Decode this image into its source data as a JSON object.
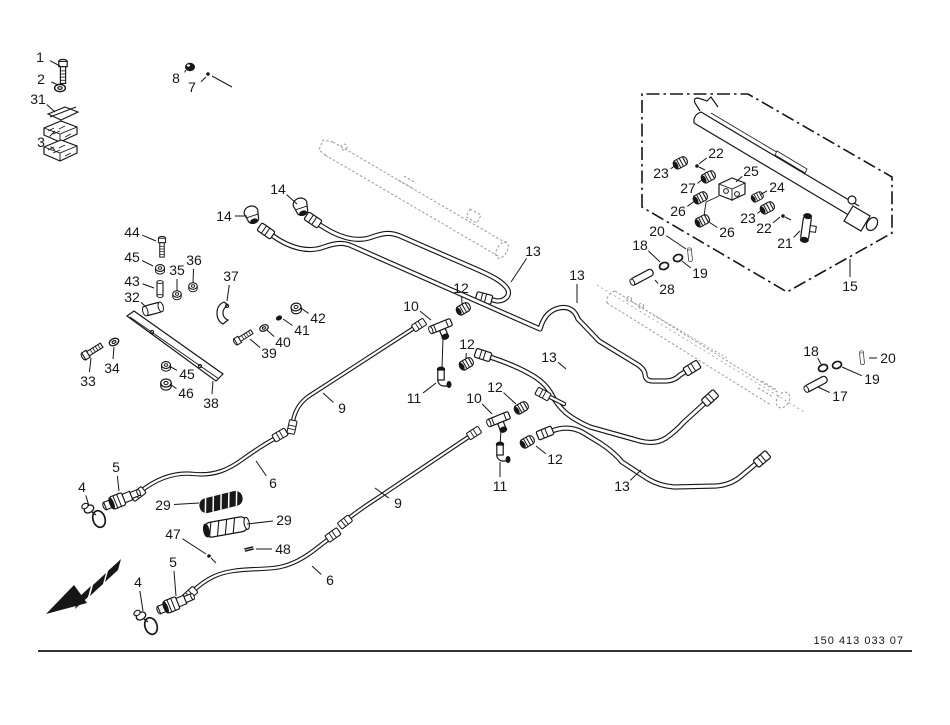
{
  "page": {
    "width": 950,
    "height": 725,
    "background": "#ffffff"
  },
  "colors": {
    "line": "#161616",
    "ghost": "#9a9a9a",
    "fill": "#ffffff"
  },
  "footer": {
    "drawing_number": "150 413 033 07"
  },
  "labels": [
    {
      "text": "1",
      "x": 40,
      "y": 57,
      "tx": 60,
      "ty": 66
    },
    {
      "text": "2",
      "x": 41,
      "y": 79,
      "tx": 58,
      "ty": 85
    },
    {
      "text": "31",
      "x": 38,
      "y": 99,
      "tx": 55,
      "ty": 112
    },
    {
      "text": "3",
      "x": 41,
      "y": 142,
      "tx": 55,
      "ty": 131,
      "tx2": 55,
      "ty2": 150
    },
    {
      "text": "8",
      "x": 176,
      "y": 78,
      "tx": 186,
      "ty": 70
    },
    {
      "text": "7",
      "x": 192,
      "y": 87,
      "tx": 206,
      "ty": 77
    },
    {
      "text": "14",
      "x": 224,
      "y": 216,
      "tx": 247,
      "ty": 216
    },
    {
      "text": "14",
      "x": 278,
      "y": 189,
      "tx": 297,
      "ty": 204
    },
    {
      "text": "44",
      "x": 132,
      "y": 232,
      "tx": 156,
      "ty": 241
    },
    {
      "text": "45",
      "x": 132,
      "y": 257,
      "tx": 153,
      "ty": 266
    },
    {
      "text": "43",
      "x": 132,
      "y": 281,
      "tx": 154,
      "ty": 288
    },
    {
      "text": "32",
      "x": 132,
      "y": 297,
      "tx": 146,
      "ty": 307
    },
    {
      "text": "35",
      "x": 177,
      "y": 270,
      "tx": 177,
      "ty": 291
    },
    {
      "text": "36",
      "x": 194,
      "y": 260,
      "tx": 193,
      "ty": 283
    },
    {
      "text": "37",
      "x": 231,
      "y": 276,
      "tx": 227,
      "ty": 301
    },
    {
      "text": "42",
      "x": 318,
      "y": 318,
      "tx": 301,
      "ty": 308
    },
    {
      "text": "41",
      "x": 302,
      "y": 330,
      "tx": 283,
      "ty": 319
    },
    {
      "text": "40",
      "x": 283,
      "y": 342,
      "tx": 267,
      "ty": 330
    },
    {
      "text": "39",
      "x": 269,
      "y": 353,
      "tx": 250,
      "ty": 339
    },
    {
      "text": "33",
      "x": 88,
      "y": 381,
      "tx": 91,
      "ty": 358
    },
    {
      "text": "34",
      "x": 112,
      "y": 368,
      "tx": 114,
      "ty": 347
    },
    {
      "text": "45",
      "x": 187,
      "y": 374,
      "tx": 169,
      "ty": 366
    },
    {
      "text": "46",
      "x": 186,
      "y": 393,
      "tx": 170,
      "ty": 384
    },
    {
      "text": "38",
      "x": 211,
      "y": 403,
      "tx": 213,
      "ty": 381
    },
    {
      "text": "9",
      "x": 342,
      "y": 408,
      "tx": 323,
      "ty": 393
    },
    {
      "text": "9",
      "x": 398,
      "y": 503,
      "tx": 375,
      "ty": 488
    },
    {
      "text": "13",
      "x": 533,
      "y": 251,
      "tx": 511,
      "ty": 282
    },
    {
      "text": "13",
      "x": 577,
      "y": 275,
      "tx": 577,
      "ty": 303
    },
    {
      "text": "13",
      "x": 549,
      "y": 357,
      "tx": 566,
      "ty": 369
    },
    {
      "text": "13",
      "x": 622,
      "y": 486,
      "tx": 641,
      "ty": 470
    },
    {
      "text": "12",
      "x": 461,
      "y": 288,
      "tx": 462,
      "ty": 304
    },
    {
      "text": "12",
      "x": 467,
      "y": 344,
      "tx": 466,
      "ty": 359
    },
    {
      "text": "12",
      "x": 495,
      "y": 387,
      "tx": 516,
      "ty": 404
    },
    {
      "text": "12",
      "x": 555,
      "y": 459,
      "tx": 536,
      "ty": 446
    },
    {
      "text": "10",
      "x": 411,
      "y": 306,
      "tx": 431,
      "ty": 320
    },
    {
      "text": "10",
      "x": 474,
      "y": 398,
      "tx": 492,
      "ty": 414
    },
    {
      "text": "11",
      "x": 414,
      "y": 398,
      "tx": 436,
      "ty": 383
    },
    {
      "text": "11",
      "x": 500,
      "y": 486,
      "tx": 500,
      "ty": 462
    },
    {
      "text": "28",
      "x": 667,
      "y": 289,
      "tx": 655,
      "ty": 280
    },
    {
      "text": "18",
      "x": 640,
      "y": 245,
      "tx": 660,
      "ty": 262
    },
    {
      "text": "20",
      "x": 657,
      "y": 231,
      "tx": 686,
      "ty": 249
    },
    {
      "text": "19",
      "x": 700,
      "y": 273,
      "tx": 682,
      "ty": 261
    },
    {
      "text": "15",
      "x": 850,
      "y": 286,
      "tx": 850,
      "ty": 259
    },
    {
      "text": "22",
      "x": 716,
      "y": 153,
      "tx": 699,
      "ty": 164
    },
    {
      "text": "23",
      "x": 661,
      "y": 173,
      "tx": 676,
      "ty": 165
    },
    {
      "text": "27",
      "x": 688,
      "y": 188,
      "tx": 703,
      "ty": 179
    },
    {
      "text": "25",
      "x": 751,
      "y": 171,
      "tx": 736,
      "ty": 182
    },
    {
      "text": "24",
      "x": 777,
      "y": 187,
      "tx": 760,
      "ty": 195
    },
    {
      "text": "23",
      "x": 748,
      "y": 218,
      "tx": 763,
      "ty": 209
    },
    {
      "text": "22",
      "x": 764,
      "y": 228,
      "tx": 780,
      "ty": 217
    },
    {
      "text": "26",
      "x": 678,
      "y": 211,
      "tx": 696,
      "ty": 200
    },
    {
      "text": "26",
      "x": 727,
      "y": 232,
      "tx": 709,
      "ty": 222
    },
    {
      "text": "21",
      "x": 785,
      "y": 243,
      "tx": 800,
      "ty": 231
    },
    {
      "text": "18",
      "x": 811,
      "y": 351,
      "tx": 821,
      "ty": 364
    },
    {
      "text": "20",
      "x": 888,
      "y": 358,
      "tx": 869,
      "ty": 358
    },
    {
      "text": "19",
      "x": 872,
      "y": 379,
      "tx": 842,
      "ty": 367
    },
    {
      "text": "17",
      "x": 840,
      "y": 396,
      "tx": 818,
      "ty": 387
    },
    {
      "text": "4",
      "x": 82,
      "y": 487,
      "tx": 89,
      "ty": 506
    },
    {
      "text": "5",
      "x": 116,
      "y": 467,
      "tx": 119,
      "ty": 491
    },
    {
      "text": "29",
      "x": 163,
      "y": 505,
      "tx": 199,
      "ty": 503
    },
    {
      "text": "6",
      "x": 273,
      "y": 483,
      "tx": 256,
      "ty": 461
    },
    {
      "text": "29",
      "x": 284,
      "y": 520,
      "tx": 247,
      "ty": 524
    },
    {
      "text": "47",
      "x": 173,
      "y": 534,
      "tx": 206,
      "ty": 554
    },
    {
      "text": "48",
      "x": 283,
      "y": 549,
      "tx": 256,
      "ty": 549
    },
    {
      "text": "4",
      "x": 138,
      "y": 582,
      "tx": 143,
      "ty": 611
    },
    {
      "text": "5",
      "x": 173,
      "y": 562,
      "tx": 176,
      "ty": 596
    },
    {
      "text": "6",
      "x": 330,
      "y": 580,
      "tx": 312,
      "ty": 566
    }
  ]
}
